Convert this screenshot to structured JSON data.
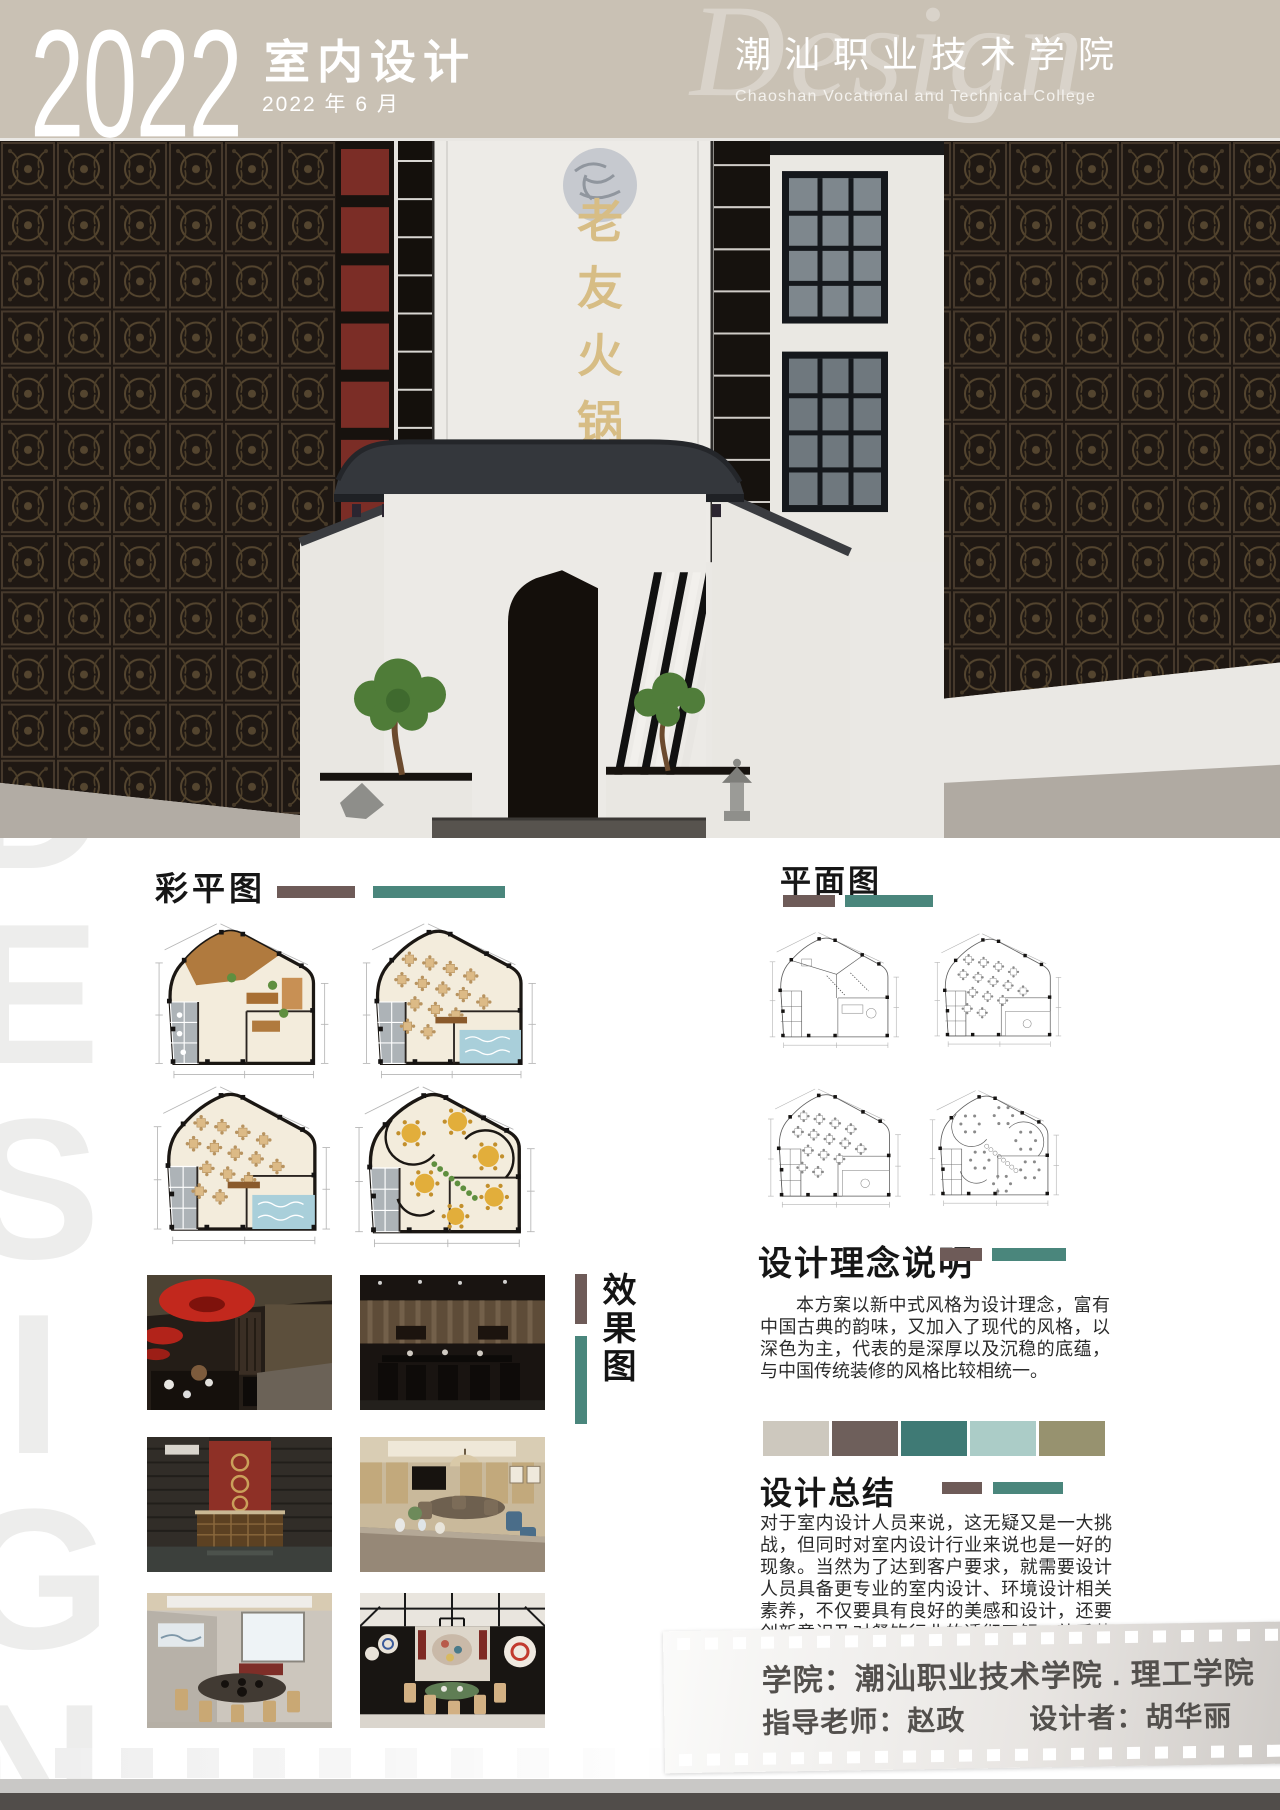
{
  "header": {
    "year": "2022",
    "title": "室内设计",
    "date": "2022 年 6 月",
    "college_cn": "潮汕职业技术学院",
    "college_en": "Chaoshan Vocational and Technical College",
    "watermark": "Design",
    "bg_color": "#c9c1b4"
  },
  "watermark_vertical": "DESIGN",
  "building": {
    "sign": "老友火锅店"
  },
  "accent": {
    "brown": "#6e5b58",
    "teal": "#4a867c"
  },
  "sections": {
    "color_plan": {
      "title": "彩平图"
    },
    "floor_plan": {
      "title": "平面图"
    },
    "concept": {
      "title": "设计理念说明",
      "body": "本方案以新中式风格为设计理念，富有中国古典的韵味，又加入了现代的风格，以深色为主，代表的是深厚以及沉稳的底蕴，与中国传统装修的风格比较相统一。"
    },
    "summary": {
      "title": "设计总结",
      "body": "对于室内设计人员来说，这无疑又是一大挑战，但同时对室内设计行业来说也是一好的现象。当然为了达到客户要求，就需要设计人员具备更专业的室内设计、环境设计相关素养，不仅要具有良好的美感和设计，还要创新意识及对餐饮行业的透彻了解，熟悉装饰工程流程和工艺。"
    },
    "renders": {
      "title": "效果图"
    }
  },
  "palette": [
    "#cdc8be",
    "#6e5f5b",
    "#3f7a75",
    "#abccc7",
    "#97926f"
  ],
  "plan_colors": {
    "floor": "#f3ecdc",
    "outline": "#1b1713",
    "wood": "#b07a3e",
    "table": "#dcba86",
    "table_dot": "#b8935f",
    "pool": "#a9cfda",
    "round_table": "#e2ae3b",
    "round_dot": "#c28f2c",
    "plant": "#5f8f3f",
    "room": "#adb3b7",
    "cad_line": "#606060",
    "dim": "#b5b5b5"
  },
  "credits": {
    "line1": "学院：潮汕职业技术学院 . 理工学院",
    "line2a": "指导老师：赵政",
    "line2b": "设计者：胡华丽"
  }
}
